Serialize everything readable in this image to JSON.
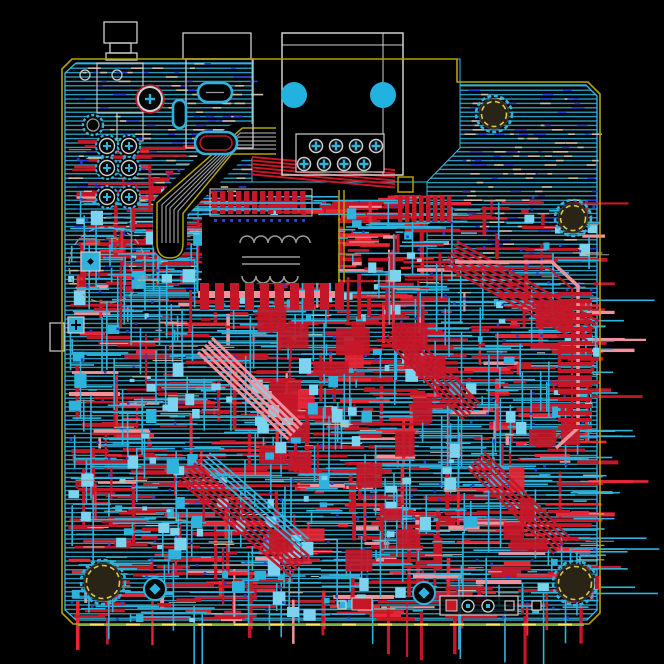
{
  "canvas": {
    "width": 664,
    "height": 664,
    "background": "#000000"
  },
  "colors": {
    "board_fill": "#040404",
    "hatch": "#2fb0d8",
    "pour_edge": "#35bce4",
    "outline": "#b3a307",
    "outline_green": "#82b13d",
    "outline_dash": "#ffe34d",
    "hole_dash": "#d9c94c",
    "silk": "#cfcfcf",
    "silk_dim": "#9a9a9a",
    "red": "#c41728",
    "red_bright": "#e82636",
    "pink": "#f0929c",
    "cyan": "#2fb3dc",
    "cyan_light": "#7cd3ef",
    "blue": "#2b3bd6",
    "tan": "#c9bfa9",
    "big_pad_cyan": "#22b2e0",
    "hole_fill": "#2a2417"
  },
  "board": {
    "outline": [
      [
        72,
        59
      ],
      [
        457,
        59
      ],
      [
        457,
        82
      ],
      [
        588,
        82
      ],
      [
        600,
        94
      ],
      [
        600,
        613
      ],
      [
        589,
        624
      ],
      [
        73,
        624
      ],
      [
        62,
        613
      ],
      [
        62,
        69
      ]
    ],
    "pour": [
      [
        76,
        63
      ],
      [
        454,
        63
      ],
      [
        454,
        85
      ],
      [
        586,
        85
      ],
      [
        597,
        96
      ],
      [
        597,
        610
      ],
      [
        587,
        620
      ],
      [
        76,
        620
      ],
      [
        65,
        610
      ],
      [
        65,
        73
      ]
    ],
    "keepouts": [
      [
        [
          252,
          59
        ],
        [
          460,
          59
        ],
        [
          460,
          148
        ],
        [
          417,
          192
        ],
        [
          252,
          192
        ]
      ],
      [
        [
          198,
          182
        ],
        [
          427,
          182
        ],
        [
          427,
          292
        ],
        [
          198,
          292
        ]
      ]
    ],
    "left_tab": [
      50,
      323,
      14,
      28
    ],
    "bottom_green": [
      78,
      625,
      584,
      625
    ],
    "hatch_spacing": 4.4
  },
  "speckle_regions": [
    {
      "x": 68,
      "y": 63,
      "w": 182,
      "h": 156,
      "n": 150,
      "seed": 3
    },
    {
      "x": 187,
      "y": 63,
      "w": 64,
      "h": 82,
      "n": 40,
      "seed": 4
    },
    {
      "x": 462,
      "y": 88,
      "w": 132,
      "h": 168,
      "n": 130,
      "seed": 5
    },
    {
      "x": 68,
      "y": 222,
      "w": 126,
      "h": 66,
      "n": 55,
      "seed": 6
    }
  ],
  "texture_regions": [
    {
      "x": 68,
      "y": 292,
      "w": 527,
      "h": 326,
      "red": 620,
      "cyan": 500,
      "pads": 110,
      "vias": 150,
      "white": 110,
      "blob": 0,
      "seed": 7
    },
    {
      "x": 68,
      "y": 186,
      "w": 132,
      "h": 106,
      "red": 90,
      "cyan": 70,
      "pads": 16,
      "vias": 22,
      "white": 18,
      "blob": 0,
      "seed": 11
    },
    {
      "x": 68,
      "y": 140,
      "w": 140,
      "h": 48,
      "red": 26,
      "cyan": 0,
      "pads": 0,
      "vias": 8,
      "white": 6,
      "blob": 0,
      "seed": 12
    },
    {
      "x": 255,
      "y": 195,
      "w": 170,
      "h": 95,
      "red": 120,
      "cyan": 55,
      "pads": 12,
      "vias": 18,
      "white": 14,
      "blob": 0,
      "seed": 13
    },
    {
      "x": 430,
      "y": 196,
      "w": 164,
      "h": 94,
      "red": 30,
      "cyan": 24,
      "pads": 6,
      "vias": 26,
      "white": 16,
      "blob": 0,
      "seed": 17
    },
    {
      "x": 250,
      "y": 300,
      "w": 330,
      "h": 250,
      "red": 30,
      "cyan": 0,
      "pads": 0,
      "vias": 0,
      "white": 0,
      "blob": 1,
      "seed": 19
    },
    {
      "x": 130,
      "y": 380,
      "w": 180,
      "h": 200,
      "red": 0,
      "cyan": 0,
      "pads": 36,
      "vias": 0,
      "white": 0,
      "blob": 0,
      "seed": 23
    }
  ],
  "bundles": [
    {
      "p": [
        450,
        253,
        592,
        333
      ],
      "n": 7,
      "c": "red",
      "w": 2.5,
      "g": 4.5
    },
    {
      "p": [
        392,
        330,
        472,
        412
      ],
      "n": 6,
      "c": "red",
      "w": 2.5,
      "g": 4.5
    },
    {
      "p": [
        188,
        470,
        300,
        566
      ],
      "n": 7,
      "c": "red",
      "w": 2.5,
      "g": 4.5
    },
    {
      "p": [
        205,
        458,
        304,
        544
      ],
      "n": 4,
      "c": "cyan",
      "w": 1.8,
      "g": 4.5
    },
    {
      "p": [
        476,
        460,
        562,
        546
      ],
      "n": 6,
      "c": "red",
      "w": 2.5,
      "g": 4.5
    },
    {
      "p": [
        205,
        345,
        295,
        432
      ],
      "n": 5,
      "c": "pink",
      "w": 3,
      "g": 5
    }
  ],
  "red_loop": {
    "outer": [
      [
        455,
        262
      ],
      [
        552,
        262
      ],
      [
        578,
        286
      ],
      [
        578,
        428
      ],
      [
        556,
        448
      ]
    ],
    "inner": [
      [
        455,
        268
      ],
      [
        549,
        268
      ],
      [
        572,
        289
      ],
      [
        572,
        425
      ],
      [
        552,
        442
      ]
    ],
    "bar_stack": {
      "x": 558,
      "y0": 292,
      "y1": 428,
      "step": 7,
      "w": 34,
      "h": 4
    }
  },
  "band": {
    "pts": [
      [
        276,
        141
      ],
      [
        237,
        141
      ],
      [
        170,
        208
      ],
      [
        170,
        243
      ]
    ],
    "half_width": 13,
    "gray_offsets": [
      -8,
      -4,
      0,
      4,
      8
    ],
    "cap": "M157,243 Q157,258 170,258 Q183,258 183,243"
  },
  "bus_lines": {
    "x0": 252,
    "y0": 157,
    "x1": 395,
    "y1": 170,
    "n": 6,
    "dy": 3.5
  },
  "transformer": {
    "box": [
      202,
      215,
      136,
      68
    ],
    "bumps_top": {
      "x0": 240,
      "y": 243,
      "n": 5,
      "r": 7
    },
    "lines": [
      [
        242,
        257,
        300,
        257
      ],
      [
        242,
        264,
        300,
        264
      ]
    ],
    "bumps_bot": {
      "x0": 242,
      "y": 276,
      "n": 4,
      "r": 7
    },
    "pad_row": {
      "rect": [
        210,
        189,
        102,
        27
      ],
      "bar_x0": 212,
      "bar_step": 8,
      "bar_n": 12,
      "bar_w": 5.5,
      "bar_h": 23,
      "bar_y": 191
    },
    "cross_traces": [
      [
        204,
        203,
        322,
        203
      ],
      [
        204,
        209,
        322,
        209
      ]
    ],
    "via_row": {
      "y": 219,
      "x0": 214,
      "step": 8,
      "n": 12
    },
    "yellow_cols": [
      [
        339,
        190,
        339,
        282
      ],
      [
        344,
        190,
        344,
        282
      ]
    ]
  },
  "comb2": {
    "yrect": [
      398,
      177,
      15,
      15
    ],
    "bar_x0": 398,
    "bar_step": 7,
    "bar_n": 8,
    "bar_y": 196,
    "bar_w": 4.5,
    "bar_h": 26
  },
  "comb_big": {
    "strip": [
      198,
      291,
      142,
      7
    ],
    "bar_x0": 200,
    "bar_step": 15,
    "bar_n": 10,
    "bar_y": 283,
    "bar_w": 9,
    "bar_h": 27
  },
  "main_connector": {
    "outer": [
      282,
      33,
      121,
      142
    ],
    "inner_h_y": 45,
    "inner_v_x": 383,
    "big_circles": [
      [
        294,
        95
      ],
      [
        383,
        95
      ]
    ],
    "big_circle_r": 13,
    "pad_grid": {
      "rect": [
        296,
        134,
        88,
        38
      ],
      "row1_y": 146,
      "row2_y": 164,
      "row1_x": [
        316,
        336,
        356,
        376
      ],
      "row2_x": [
        304,
        324,
        344,
        364
      ],
      "pad_r": 6.5
    }
  },
  "hdmi_connector": {
    "outer": [
      183,
      33,
      68,
      26
    ],
    "body": [
      186,
      59,
      67,
      89
    ]
  },
  "barrel_jack": {
    "rects": [
      [
        104,
        22,
        33,
        21
      ],
      [
        110,
        43,
        21,
        10
      ],
      [
        106,
        53,
        31,
        7
      ]
    ]
  },
  "jack_inner": {
    "rects": [
      [
        97,
        63,
        46,
        50
      ],
      [
        117,
        113,
        26,
        28
      ]
    ]
  },
  "th_cluster": {
    "cols": [
      107,
      129
    ],
    "rows": [
      146,
      168,
      197
    ],
    "r": 11,
    "ring_red": [
      150,
      99,
      12
    ],
    "ring_cyan": [
      93,
      125,
      10
    ],
    "small_rings": [
      [
        85,
        75,
        5
      ],
      [
        117,
        75,
        5
      ]
    ]
  },
  "ovals": [
    [
      173,
      100,
      13,
      28
    ],
    [
      198,
      83,
      34,
      19
    ],
    [
      195,
      132,
      42,
      22
    ]
  ],
  "squares": [
    {
      "x": 81,
      "y": 252,
      "s": 19,
      "glyph": "dot"
    },
    {
      "x": 68,
      "y": 317,
      "s": 16,
      "glyph": "cross"
    }
  ],
  "cap_circle": [
    107,
    265,
    38
  ],
  "rings": [
    [
      155,
      589,
      11
    ],
    [
      424,
      593,
      11
    ]
  ],
  "bottom_fp": {
    "rect": [
      440,
      596,
      78,
      19
    ],
    "red_sq": [
      446,
      600,
      11,
      11
    ],
    "rings": [
      [
        468,
        606
      ],
      [
        488,
        606
      ]
    ],
    "ring_r": 6,
    "sq": [
      505,
      601,
      9,
      9
    ],
    "lone_sq": [
      532,
      601,
      9,
      9
    ],
    "red_rect": [
      352,
      598,
      20,
      12
    ],
    "sq2": [
      338,
      601,
      8,
      8
    ]
  },
  "mounting_holes": [
    [
      494,
      114,
      15
    ],
    [
      573,
      218,
      15
    ],
    [
      103,
      582,
      19
    ],
    [
      575,
      583,
      19
    ]
  ],
  "red_tick": [
    595,
    576,
    6,
    13
  ]
}
